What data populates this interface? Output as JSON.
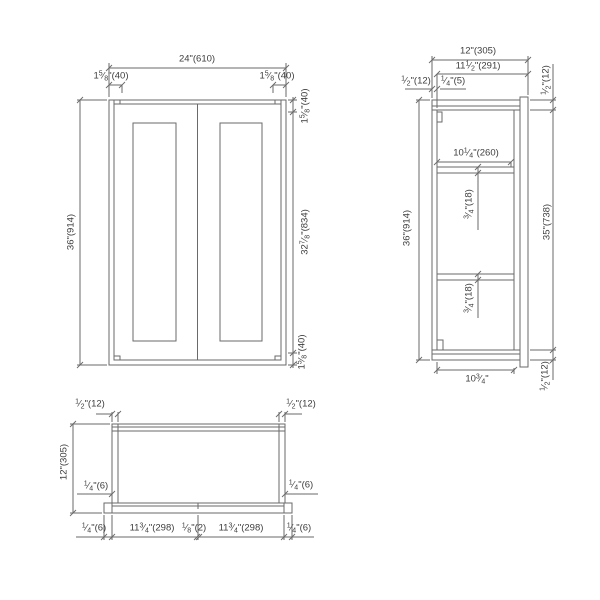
{
  "drawing": {
    "line_color": "#6a6a6a",
    "front_view": {
      "width": "24\"(610)",
      "left_stile": "1 5/8\"(40)",
      "right_stile": "1 5/8\"(40)",
      "height": "36\"(914)",
      "top_rail": "1 5/8\"(40)",
      "door_height": "32 7/8\"(834)",
      "bottom_rail": "1 5/8\"(40)"
    },
    "side_view": {
      "depth": "12\"(305)",
      "inner_depth": "11 1/2\"(291)",
      "back_panel": "1/2\"(12)",
      "reveal": "1/4\"(5)",
      "top_thickness": "1/2\"(12)",
      "height": "36\"(914)",
      "interior_height": "35\"(738)",
      "bottom_thickness": "1/2\"(12)",
      "shelf_depth": "10 1/4\"(260)",
      "shelf_thickness_upper": "3/4\"(18)",
      "shelf_thickness_lower": "3/4\"(18)",
      "interior_width": "10 3/4\""
    },
    "plan_view": {
      "left_side_thickness": "1/2\"(12)",
      "right_side_thickness": "1/2\"(12)",
      "depth": "12\"(305)",
      "left_reveal": "1/4\"(6)",
      "right_reveal": "1/4\"(6)",
      "bottom_row": [
        "1/4\"(6)",
        "11 3/4\"(298)",
        "1/8\"(2)",
        "11 3/4\"(298)",
        "1/4\"(6)"
      ]
    }
  }
}
